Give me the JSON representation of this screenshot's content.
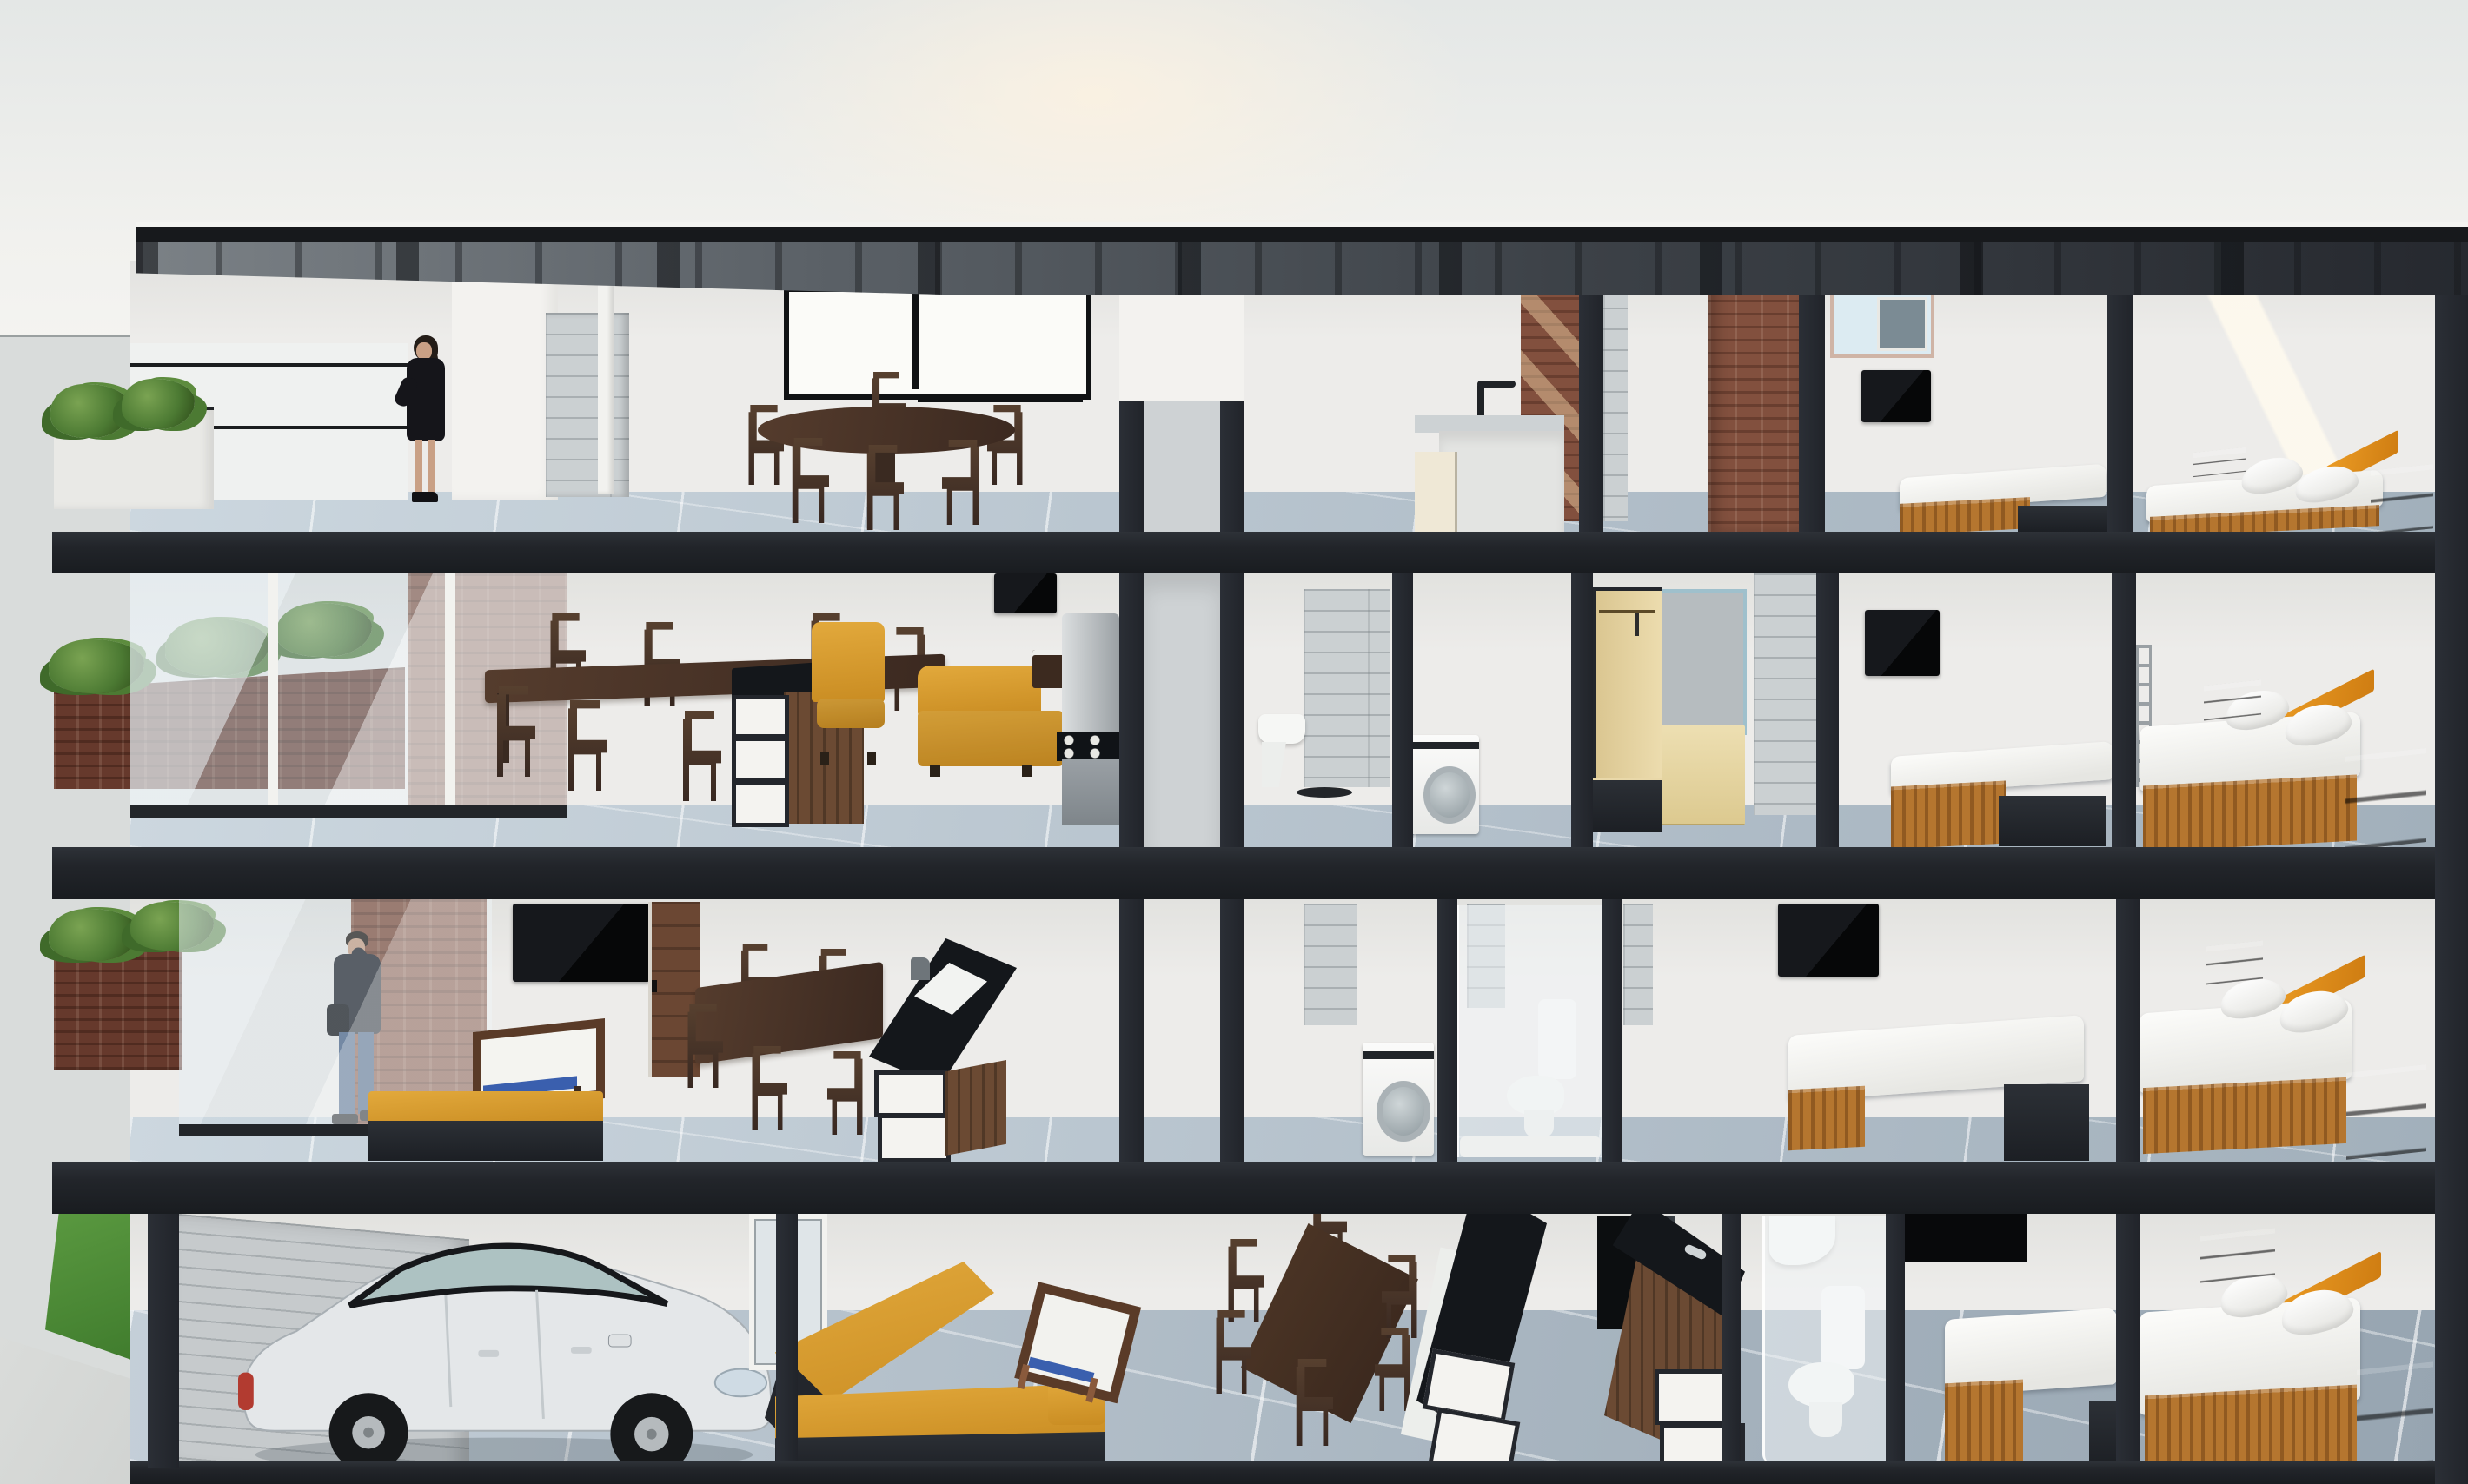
{
  "scene": {
    "type": "architectural-cutaway-render",
    "setting": "daylight cross-section of a four-story residential building, pale sky, street at left",
    "people": [
      {
        "id": "woman-terrace",
        "floor": 4,
        "label": "Woman in black dress standing on the rooftop terrace"
      },
      {
        "id": "man-balcony",
        "floor": 2,
        "label": "Man talking on the phone on the balcony"
      }
    ],
    "vehicle": {
      "type": "sedan",
      "color_name": "white",
      "label": "White sedan parked in the ground-floor garage"
    },
    "floors": [
      {
        "level": 4,
        "rooms": [
          "roof terrace with white planter and glass parapet",
          "open dining room with round table and six chairs",
          "kitchenette with concrete sink counter",
          "hall with brick feature walls and pergola shadows",
          "bedroom with wall tv and single bed",
          "bedroom with double bed and orange headboard"
        ]
      },
      {
        "level": 3,
        "rooms": [
          "brick balcony planter behind glass facade",
          "dining room with long table and chairs",
          "kitchen island with black counter and white shelves",
          "living area with two mustard sofas, tray table and tv",
          "kitchen run with steel fridge and gas cooktop",
          "bathroom with wall-hung sink",
          "laundry nook with washing machine",
          "walk-in closet with tan wardrobe and dresser",
          "bedroom with wall tv and single bed",
          "bedroom with double bed and orange headboard"
        ]
      },
      {
        "level": 2,
        "rooms": [
          "balcony with brick planter",
          "living room with large wall tv, coffee table and yellow bench",
          "dining room with table and chairs",
          "kitchen island with sink",
          "laundry nook with washing machine",
          "bathroom with glass shower screen and toilet",
          "bedroom with wall tv and bed",
          "bedroom with double bed and orange headboard"
        ]
      },
      {
        "level": 1,
        "rooms": [
          "street edge with grass verge",
          "garage with parked white car and plank wall",
          "living room with l-shaped yellow sofa and coffee table",
          "dining room with table and chairs",
          "kitchen with two black-top counters and dark fridge",
          "bathroom with toilet behind frosted glass",
          "bedroom with single bed and dark transom opening",
          "bedroom with double bed and orange headboard"
        ]
      }
    ],
    "structure": {
      "core": "central light concrete service core flanked by dark cut walls",
      "slabs": "dark sectioned floor slabs and party walls",
      "roof": "thin flat roof with exposed rafters sloping over the terrace"
    }
  },
  "labels": {
    "building": "Cutaway section of four-story residential building",
    "roof": "Flat roof with exposed rafter soffit",
    "core": "Central service core and shaft",
    "woman": "Woman standing on the rooftop terrace",
    "man": "Man talking on the phone on the balcony",
    "car": "White sedan parked in the garage",
    "round-table": "Round wooden dining table with six chairs",
    "long-table": "Long wooden dining table with chairs",
    "island": "Kitchen island with black countertop and open white shelving",
    "sofa": "Mustard yellow sofa",
    "washer": "Front-loading washing machine",
    "toilet": "White toilet",
    "wardrobe": "Tan open wardrobe with drawers",
    "double-bed": "Double bed with orange headboard and wooden base",
    "single-bed": "Single bed with wooden base",
    "planter": "Brick planter with green shrubs",
    "grass": "Grass verge at street level",
    "fridge": "Refrigerator",
    "cooktop": "Gas cooktop with four burners",
    "coffee-table": "Wooden coffee table with white top and blue shelf",
    "tv": "Wall-mounted television",
    "shower": "Glass shower screen",
    "sink": "Wall-hung washbasin",
    "stone-door": "Stone-clad panel door",
    "window": "Window with black frame"
  },
  "palette": {
    "slab": "#24272d",
    "wall": "#edecea",
    "wall-bright": "#f4f3f0",
    "floor-tile": "#bfccd6",
    "stone": "#cbd0d2",
    "plank": "#c6cacc",
    "brick": "#82503e",
    "brick-dark": "#66392c",
    "grass": "#4e8c39",
    "plant": "#4c7a33",
    "sofa-yellow": "#d79a2f",
    "accent-orange": "#e5941f",
    "wood-bed": "#b5762f",
    "wood-dark": "#46322a",
    "wood-door": "#6b4733",
    "wood-night": "#3a2718",
    "counter-black": "#14171b",
    "steel": "#b7bcbf",
    "mattress": "#f6f6f3",
    "car-body": "#e3e6e8",
    "coffee-blue": "#3a5fae",
    "tan": "#e9d8a9",
    "glass-tint": "#dfe8ee",
    "sea": "#d9dcdb",
    "pavement": "#d3d5d3"
  }
}
